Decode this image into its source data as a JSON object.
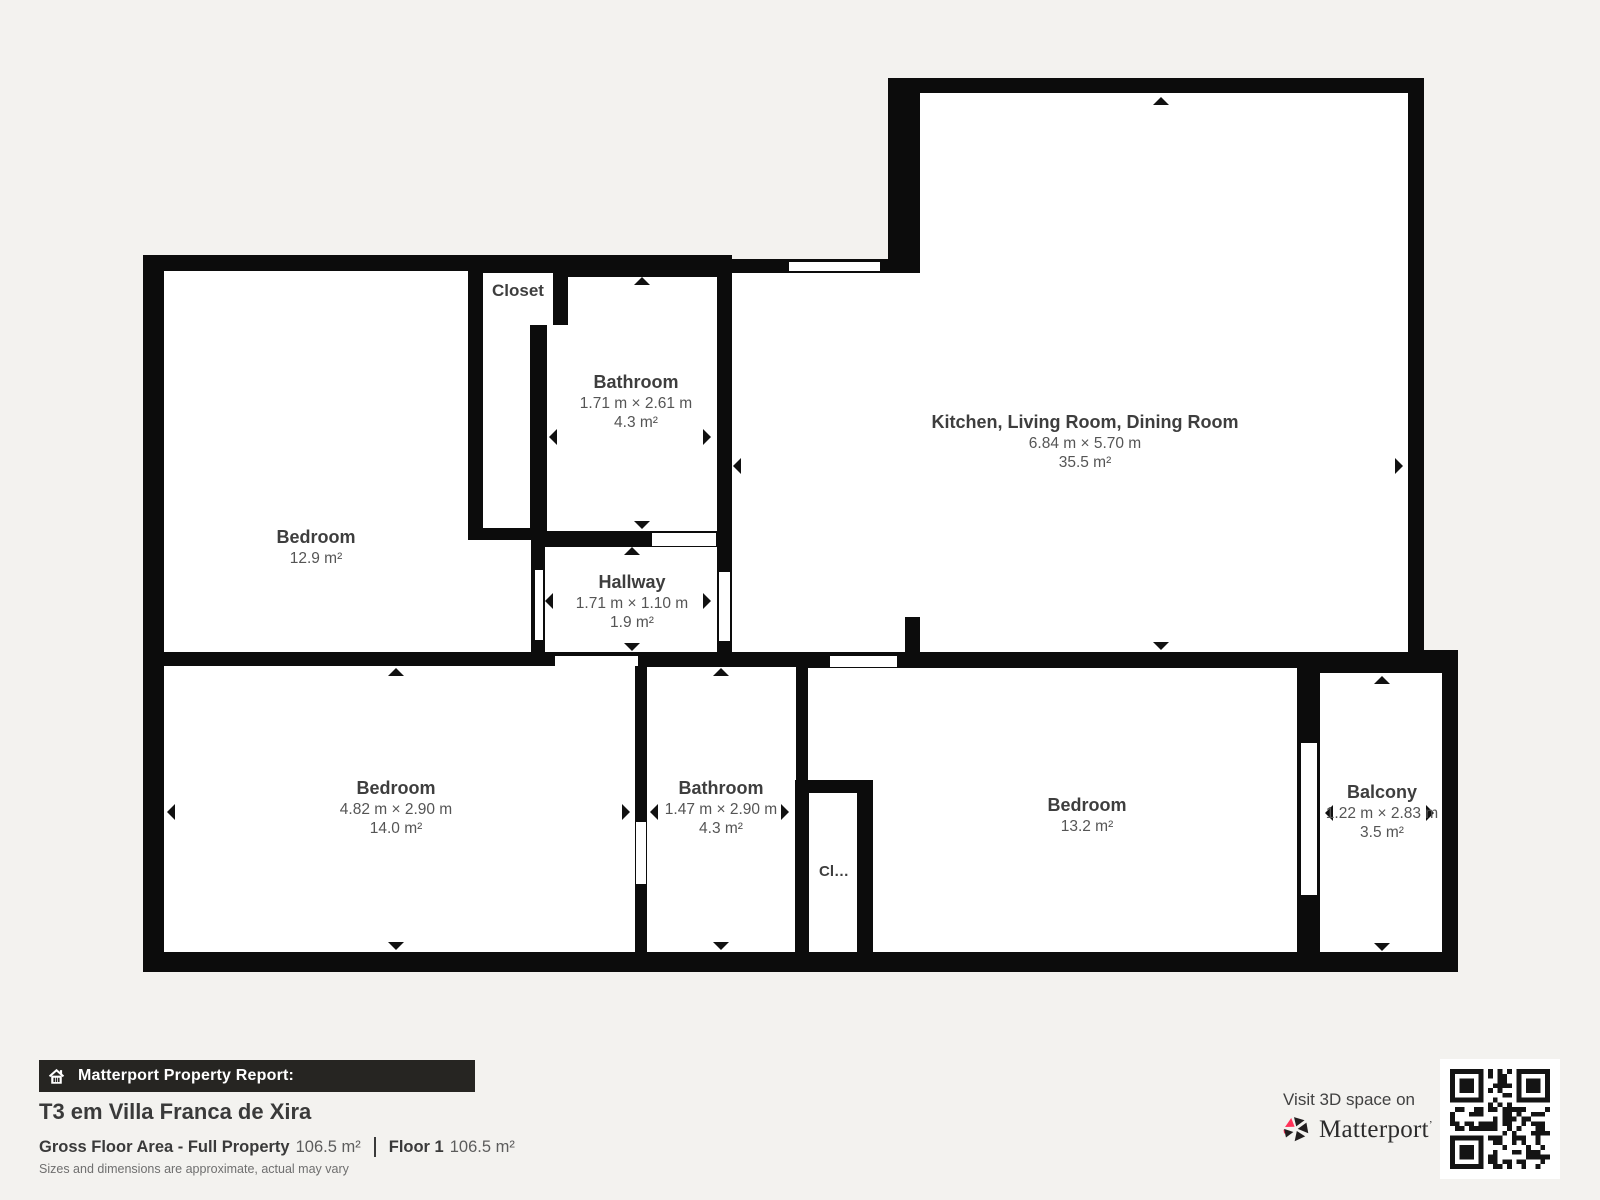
{
  "plan": {
    "rooms": [
      {
        "name": "Bedroom",
        "area": "12.9 m²"
      },
      {
        "name": "Closet"
      },
      {
        "name": "Bathroom",
        "dims": "1.71 m × 2.61 m",
        "area": "4.3 m²"
      },
      {
        "name": "Hallway",
        "dims": "1.71 m × 1.10 m",
        "area": "1.9 m²"
      },
      {
        "name": "Kitchen, Living Room, Dining Room",
        "dims": "6.84 m × 5.70 m",
        "area": "35.5 m²"
      },
      {
        "name": "Bedroom",
        "dims": "4.82 m × 2.90 m",
        "area": "14.0 m²"
      },
      {
        "name": "Bathroom",
        "dims": "1.47 m × 2.90 m",
        "area": "4.3 m²"
      },
      {
        "name": "Cl…"
      },
      {
        "name": "Bedroom",
        "area": "13.2 m²"
      },
      {
        "name": "Balcony",
        "dims": "1.22 m × 2.83 m",
        "area": "3.5 m²"
      }
    ]
  },
  "footer": {
    "report_label": "Matterport Property Report:",
    "title": "T3 em Villa Franca de Xira",
    "gross_label": "Gross Floor Area - Full Property",
    "gross_value": "106.5 m²",
    "floor_label": "Floor 1",
    "floor_value": "106.5 m²",
    "disclaimer": "Sizes and dimensions are approximate, actual may vary",
    "visit_text": "Visit 3D space on",
    "brand": "Matterport"
  },
  "colors": {
    "wall": "#0c0c0c",
    "background": "#f3f2ef",
    "room_fill": "#ffffff",
    "brand_pink": "#ff3158",
    "bar_background": "#262522"
  }
}
